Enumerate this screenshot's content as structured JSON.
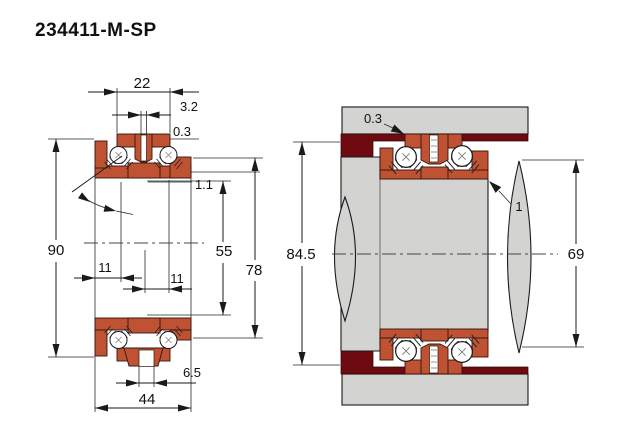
{
  "title": "234411-M-SP",
  "colors": {
    "bearing_orange": "#BF5233",
    "spacer_dark_red": "#6E0B10",
    "steel_gray": "#D3D3D1",
    "line": "#1A1A1A"
  },
  "left_view": {
    "dims": {
      "washer_width": "22",
      "top_slot_width": "3.2",
      "chamfer": "0.3",
      "face_step": "1.1",
      "outer_diameter": "90",
      "bore_diameter": "55",
      "shoulder_diameter": "78",
      "row_offset_left": "11",
      "row_offset_right": "11",
      "bottom_slot_width": "6.5",
      "total_width": "44"
    }
  },
  "right_view": {
    "dims": {
      "chamfer": "0.3",
      "callout": "1",
      "washer_outer_diameter": "84.5",
      "shaft_diameter": "69"
    }
  }
}
